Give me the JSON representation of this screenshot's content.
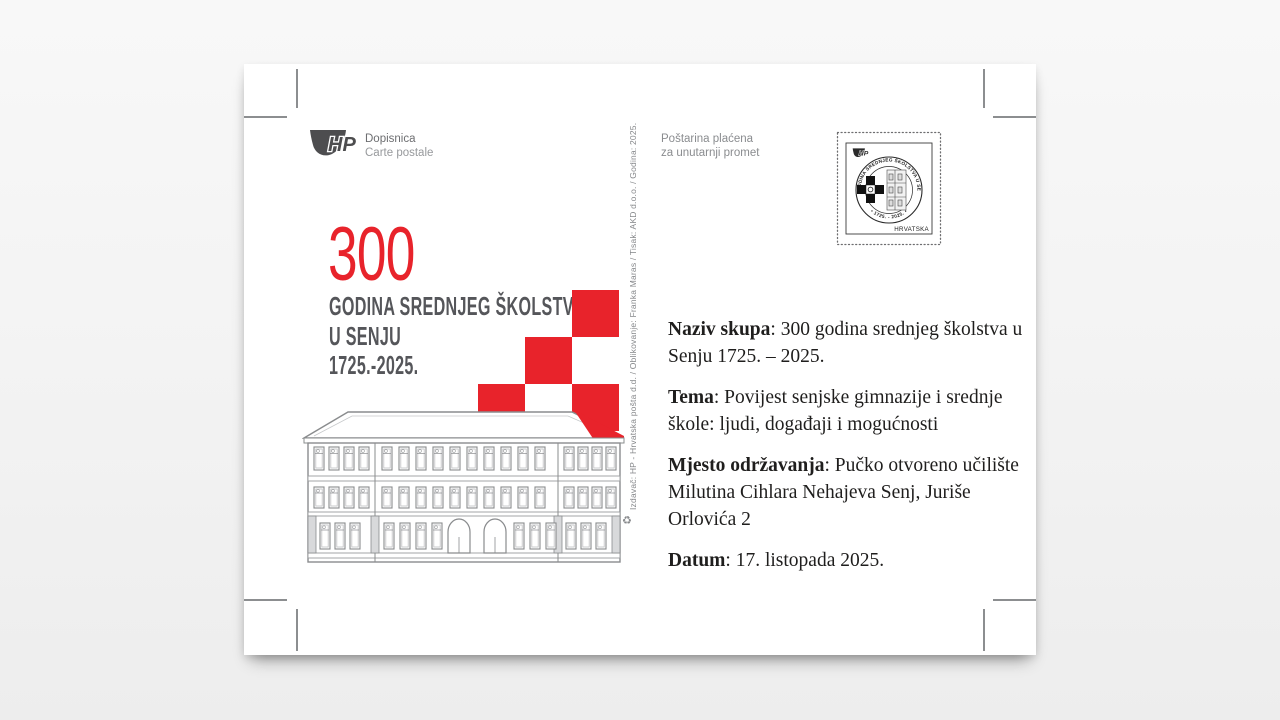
{
  "accent_red": "#e8232b",
  "header": {
    "logo_text": "HP",
    "card_type_line1": "Dopisnica",
    "card_type_line2": "Carte postale",
    "postage_line1": "Poštarina plaćena",
    "postage_line2": "za unutarnji promet"
  },
  "stamp": {
    "logo_text": "HP",
    "seal_text_top": "300 GODINA SREDNJEG ŠKOLSTVA U SENJU",
    "seal_text_bottom": "• 1725. - 2025. •",
    "country": "HRVATSKA"
  },
  "artwork": {
    "big_number": "300",
    "title_line1": "GODINA SREDNJEG ŠKOLSTVA",
    "title_line2": "U SENJU",
    "title_line3": "1725.-2025.",
    "imprint": "Izdavač: HP - Hrvatska pošta d.d. / Oblikovanje: Franka Maras / Tisak: AKD d.o.o. / Godina: 2025.",
    "recycle_icon": "♻"
  },
  "details": {
    "items": [
      {
        "label": "Naziv skupa",
        "text": ": 300 godina srednjeg školstva u Senju 1725. – 2025."
      },
      {
        "label": "Tema",
        "text": ": Povijest senjske gimnazije i srednje škole: ljudi, događaji i mogućnosti"
      },
      {
        "label": "Mjesto održavanja",
        "text": ": Pučko otvoreno učilište Milutina Cihlara Nehajeva Senj, Juriše Orlovića 2"
      },
      {
        "label": "Datum",
        "text": ": 17. listopada 2025."
      }
    ]
  }
}
